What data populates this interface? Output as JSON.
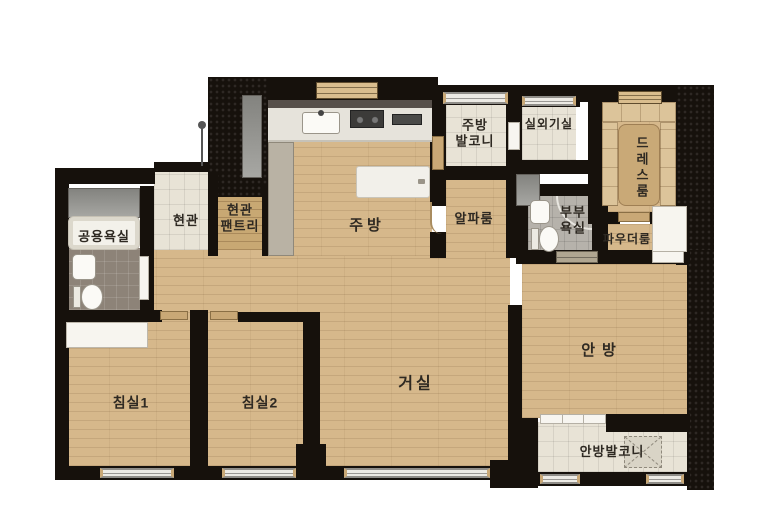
{
  "rooms": {
    "shared_bathroom": {
      "label": "공용욕실"
    },
    "entrance": {
      "label": "현관"
    },
    "entrance_pantry": {
      "lines": [
        "현관",
        "팬트리"
      ]
    },
    "kitchen": {
      "label": "주방"
    },
    "kitchen_balcony": {
      "lines": [
        "주방",
        "발코니"
      ]
    },
    "outdoor_unit_room": {
      "label": "실외기실"
    },
    "dress_room": {
      "label": "드레스룸"
    },
    "alpha_room": {
      "label": "알파룸"
    },
    "master_bathroom": {
      "lines": [
        "부부",
        "욕실"
      ]
    },
    "powder_room": {
      "label": "파우더룸"
    },
    "master_bedroom": {
      "label": "안방"
    },
    "living_room": {
      "label": "거실"
    },
    "bedroom1": {
      "label": "침실1"
    },
    "bedroom2": {
      "label": "침실2"
    },
    "master_balcony": {
      "label": "안방발코니"
    }
  },
  "icons": {
    "entrance_marker": "pole-with-knob"
  },
  "colors": {
    "wall": "#16110c",
    "wood_floor": "#d6b88b",
    "tile_light": "#e8e3d6",
    "tile_grey": "#b6b2ab",
    "tile_dark": "#8d8378",
    "fixture_white": "#f7f5ef",
    "label_text": "#2e2922",
    "background": "#ffffff"
  }
}
